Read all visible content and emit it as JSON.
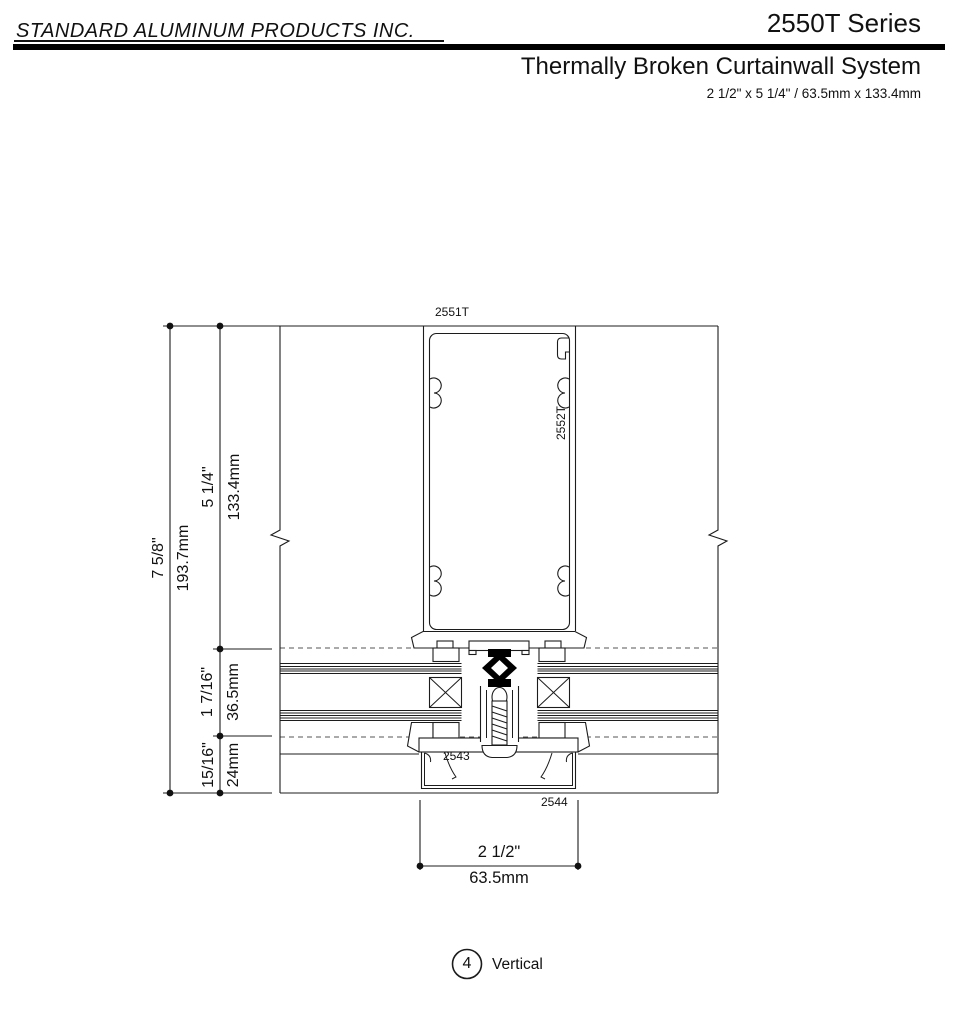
{
  "header": {
    "company": "STANDARD ALUMINUM PRODUCTS INC.",
    "series": "2550T Series",
    "product": "Thermally Broken Curtainwall System",
    "size_spec": "2 1/2\" x 5 1/4\" / 63.5mm x 133.4mm"
  },
  "drawing": {
    "labels": {
      "mullion": "2551T",
      "adapter": "2552T",
      "pressure_plate": "2543",
      "cover_cap": "2544"
    },
    "dims": {
      "overall_in": "7 5/8\"",
      "overall_mm": "193.7mm",
      "top_in": "5 1/4\"",
      "top_mm": "133.4mm",
      "mid_in": "1 7/16\"",
      "mid_mm": "36.5mm",
      "bottom_in": "15/16\"",
      "bottom_mm": "24mm",
      "width_in": "2 1/2\"",
      "width_mm": "63.5mm"
    },
    "caption": {
      "number": "4",
      "name": "Vertical"
    }
  },
  "colors": {
    "line": "#1c1c1c",
    "background": "#ffffff"
  }
}
